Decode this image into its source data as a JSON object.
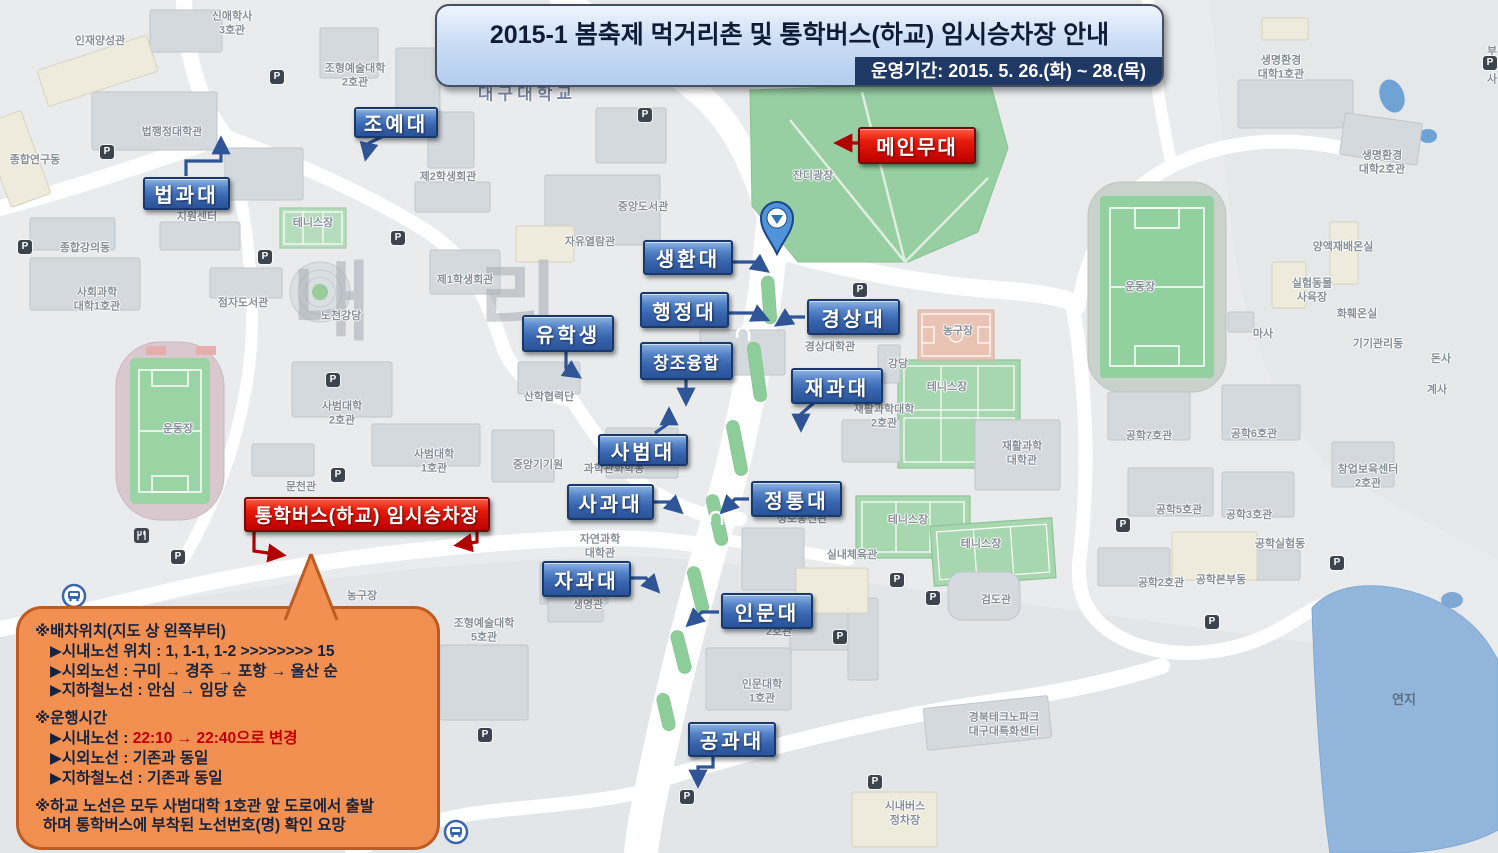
{
  "banner": {
    "title": "2015-1 봄축제 먹거리촌 및 통학버스(하교) 임시승차장 안내",
    "period": "운영기간: 2015. 5. 26.(화) ~ 28.(목)"
  },
  "stage_label": "메인무대",
  "busstop_label": "통학버스(하교) 임시승차장",
  "college_labels": [
    "조예대",
    "법과대",
    "생환대",
    "행정대",
    "경상대",
    "유학생",
    "창조융합",
    "재과대",
    "사범대",
    "사과대",
    "정통대",
    "자과대",
    "인문대",
    "공과대"
  ],
  "notice": {
    "s1_title": "※배차위치(지도 상 왼쪽부터)",
    "s1_items": [
      "▶시내노선 위치 : 1, 1-1, 1-2 >>>>>>>> 15",
      "▶시외노선 : 구미 → 경주 → 포항 → 울산 순",
      "▶지하철노선 : 안심 → 임당 순"
    ],
    "s2_title": "※운행시간",
    "s2_line1_prefix": "▶시내노선 : ",
    "s2_line1_red": "22:10 → 22:40으로 변경",
    "s2_items": [
      "▶시외노선 : 기존과 동일",
      "▶지하철노선 : 기존과 동일"
    ],
    "s3_line1": "※하교 노선은 모두 사범대학 1호관 앞 도로에서 출발",
    "s3_line2": "하며 통학버스에 부착된 노선번호(명) 확인 요망"
  },
  "icons": {
    "parking": "P"
  },
  "watermark": "내 리",
  "map_labels": [
    "신애학사\n3호관",
    "인재양성관",
    "조형예술대학\n2호관",
    "생명환경\n대학1호관",
    "부속\n사",
    "법행정대학관",
    "종합연구동",
    "지원센터",
    "테니스장",
    "제2학생회관",
    "종합강의동",
    "사회과학\n대학1호관",
    "점자도서관",
    "노천강당",
    "제1학생회관",
    "자유열람관",
    "중앙도서관",
    "잔디광장",
    "대구대학교",
    "경상대학관",
    "강당",
    "농구장",
    "테니스장",
    "재활과학대학\n2호관",
    "재활과학\n대학관",
    "공학7호관",
    "공학6호관",
    "공학5호관",
    "공학3호관",
    "창업보육센터\n2호관",
    "공학실험동",
    "공학2호관",
    "공학본부동",
    "검도관",
    "실내체육관",
    "테니스장",
    "테니스장",
    "정보통신관",
    "시내버스\n정차장",
    "경북테크노파크\n대구대특화센터",
    "인문대학\n1호관",
    "2호관",
    "생명관",
    "조형예술대학\n5호관",
    "사범대학\n2호관",
    "사범대학\n1호관",
    "문천관",
    "중앙기기원",
    "과학관화학동",
    "산학협력단",
    "자연과학\n대학관",
    "마사",
    "양액재배온실",
    "실험동물\n사육장",
    "화훼온실",
    "기기관리동",
    "돈사",
    "계사",
    "생명환경\n대학2호관",
    "연지",
    "운동장",
    "운동장",
    "농구장"
  ]
}
